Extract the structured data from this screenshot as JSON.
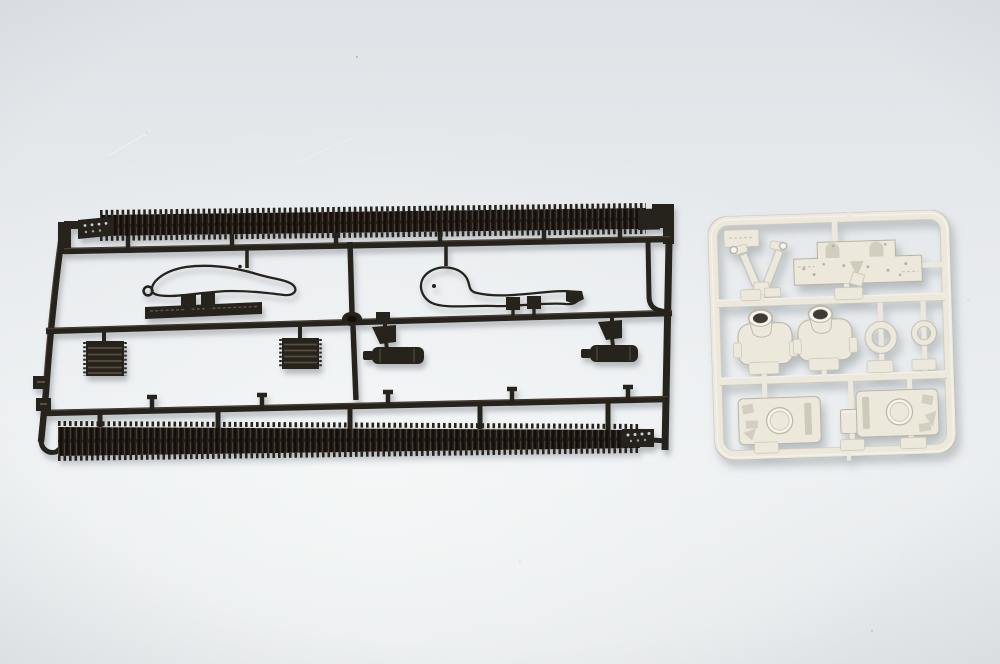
{
  "scene": {
    "type": "photograph",
    "description": "Top-down photograph of two injection-molded plastic model kit sprues lying on a light gray surface: a large dark brown-black sprue holding two long toothed tank-track runs, tow cables, grille blocks and mufflers, and a smaller light cream-white sprue holding turret bodies, hull roof plates with round hatches, rings and small fittings"
  },
  "colors": {
    "background_top": "#e0e4e8",
    "background_mid": "#e9ecee",
    "background_light": "#f3f5f6",
    "background_bottom": "#e5e8ea",
    "black_plastic": "#27211a",
    "black_plastic_dark": "#15110d",
    "black_plastic_highlight": "#5f5444",
    "track_link_mid": "#463c30",
    "white_plastic": "#ece9dc",
    "white_plastic_bright": "#f7f5ee",
    "white_plastic_shade": "#c9c3b4",
    "white_plastic_outline": "#b9b2a2",
    "opening_dark": "#3f3a32",
    "shadow": "#8d949a",
    "dot_light": "#cdd1d4"
  },
  "black_sprue": {
    "material": "dark brown-black styrene runner frame",
    "parts": [
      {
        "name": "upper-track-run",
        "desc": "long toothed tank track length along the top of the frame with flat end tab and locating holes"
      },
      {
        "name": "lower-track-run",
        "desc": "long toothed tank track length along the bottom of the frame with dotted end tab"
      },
      {
        "name": "tow-cable-left",
        "desc": "looped tow cable with eye fitting and two clamp blocks"
      },
      {
        "name": "tow-cable-right",
        "desc": "looped tow cable with hooked end fitting and two clamp blocks"
      },
      {
        "name": "grille-left",
        "desc": "slatted engine grille block"
      },
      {
        "name": "grille-center",
        "desc": "slatted engine grille block"
      },
      {
        "name": "muffler-left",
        "desc": "cylindrical exhaust muffler with mounting bracket"
      },
      {
        "name": "muffler-right",
        "desc": "cylindrical exhaust muffler with mounting bracket"
      },
      {
        "name": "marking-plate",
        "desc": "raised strip on middle runner with embossed lettering"
      }
    ]
  },
  "white_sprue": {
    "material": "cream-white styrene runner frame, rounded square",
    "parts": [
      {
        "name": "v-bracket",
        "desc": "V-shaped bracket with two ringed arms"
      },
      {
        "name": "engine-deck-plate",
        "desc": "wide stepped flat plate with rivets and two arched vents"
      },
      {
        "name": "turret-body-1",
        "desc": "small turret body with open round collar"
      },
      {
        "name": "turret-body-2",
        "desc": "small turret body with open round collar"
      },
      {
        "name": "ring-large",
        "desc": "large circular ring part"
      },
      {
        "name": "ring-small",
        "desc": "small circular ring part"
      },
      {
        "name": "hull-roof-1",
        "desc": "rectangular roof plate with circular hatch and side slot"
      },
      {
        "name": "hull-roof-2",
        "desc": "rectangular roof plate with circular hatch and side slot"
      },
      {
        "name": "small-box",
        "desc": "small square block part"
      },
      {
        "name": "corner-tab",
        "desc": "molded identification tab in frame corner"
      }
    ]
  }
}
